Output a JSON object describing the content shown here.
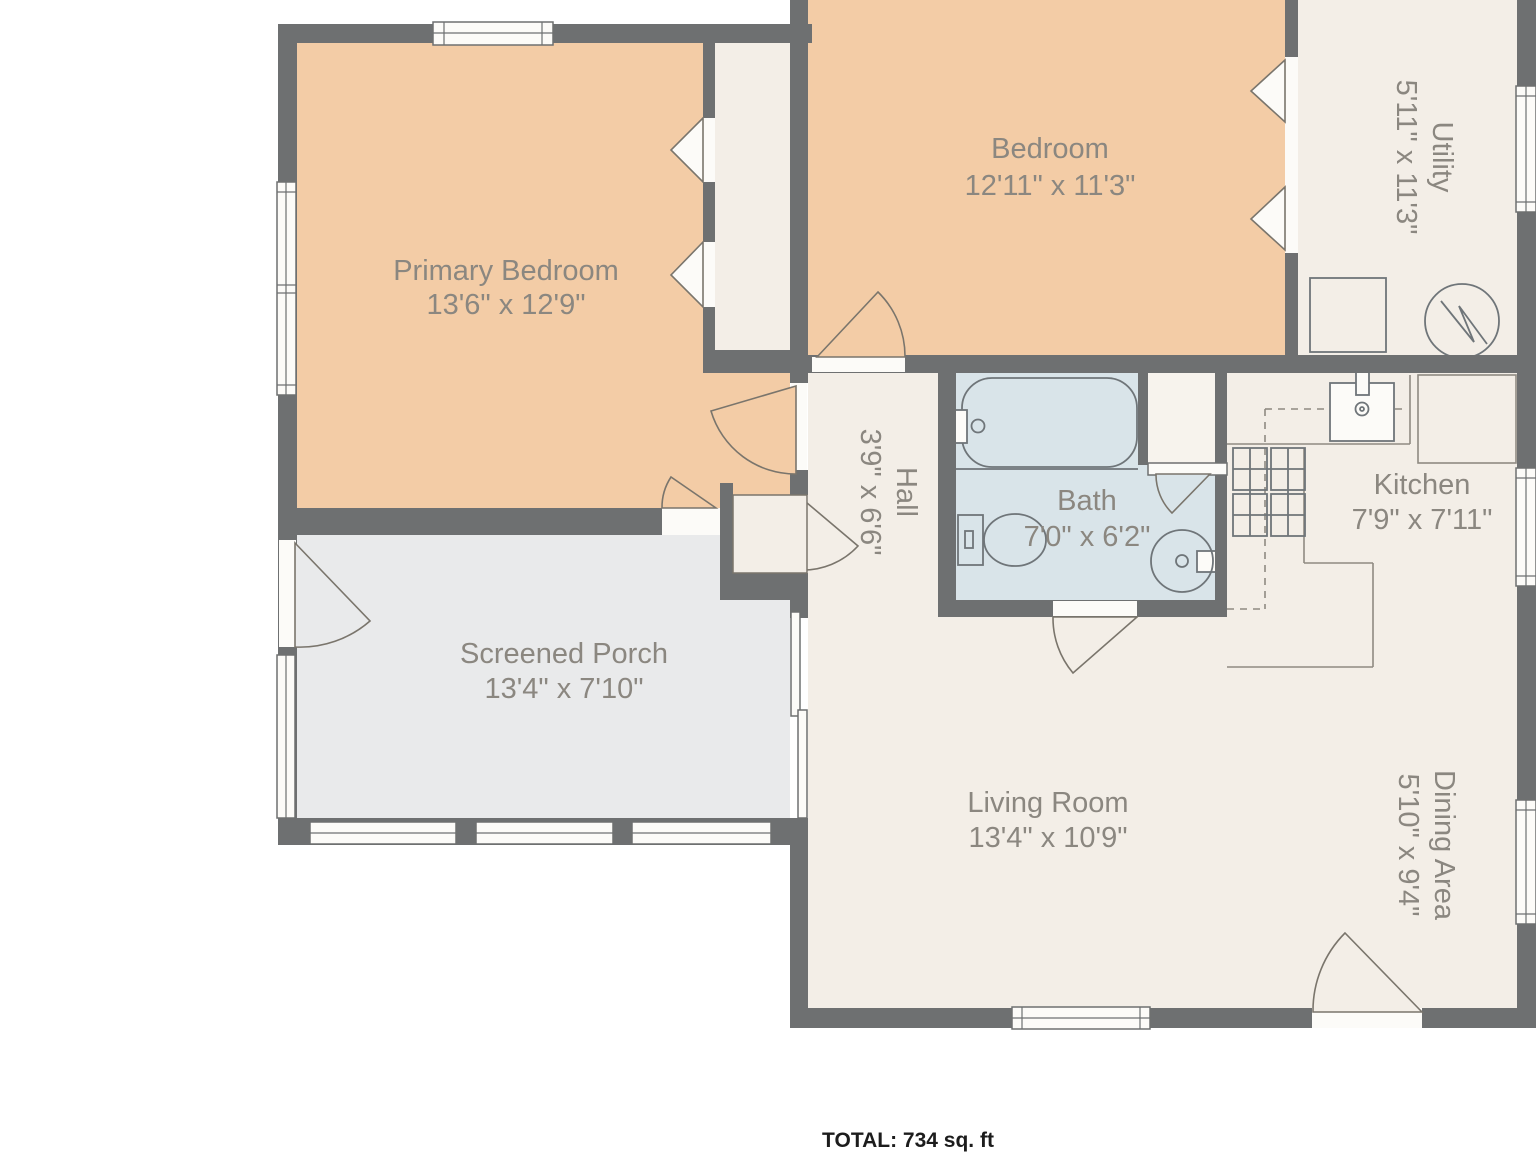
{
  "floorplan": {
    "rooms": [
      {
        "name": "Primary Bedroom",
        "dims": "13'6\" x 12'9\""
      },
      {
        "name": "Bedroom",
        "dims": "12'11\" x 11'3\""
      },
      {
        "name": "Utility",
        "dims": "5'11\" x 11'3\""
      },
      {
        "name": "Bath",
        "dims": "7'0\" x 6'2\""
      },
      {
        "name": "Kitchen",
        "dims": "7'9\" x 7'11\""
      },
      {
        "name": "Hall",
        "dims": "3'9\" x 6'6\""
      },
      {
        "name": "Screened Porch",
        "dims": "13'4\" x 7'10\""
      },
      {
        "name": "Living Room",
        "dims": "13'4\" x 10'9\""
      },
      {
        "name": "Dining Area",
        "dims": "5'10\" x 9'4\""
      }
    ],
    "total": "TOTAL: 734 sq. ft",
    "colors": {
      "bg": "#FFFFFF",
      "wall": "#6E7071",
      "bedroomFill": "#F3CCA6",
      "creamFill": "#F3EEE7",
      "alcoveFill": "#F7F3ED",
      "bathFill": "#D9E4E9",
      "porchFill": "#E9EAEB",
      "window": "#FCFBF8",
      "fixture": "#6F7579",
      "doorstroke": "#7A756C",
      "kitchenline": "#8F8A82",
      "label": "#8B8780",
      "total": "#1C1C1C"
    }
  }
}
